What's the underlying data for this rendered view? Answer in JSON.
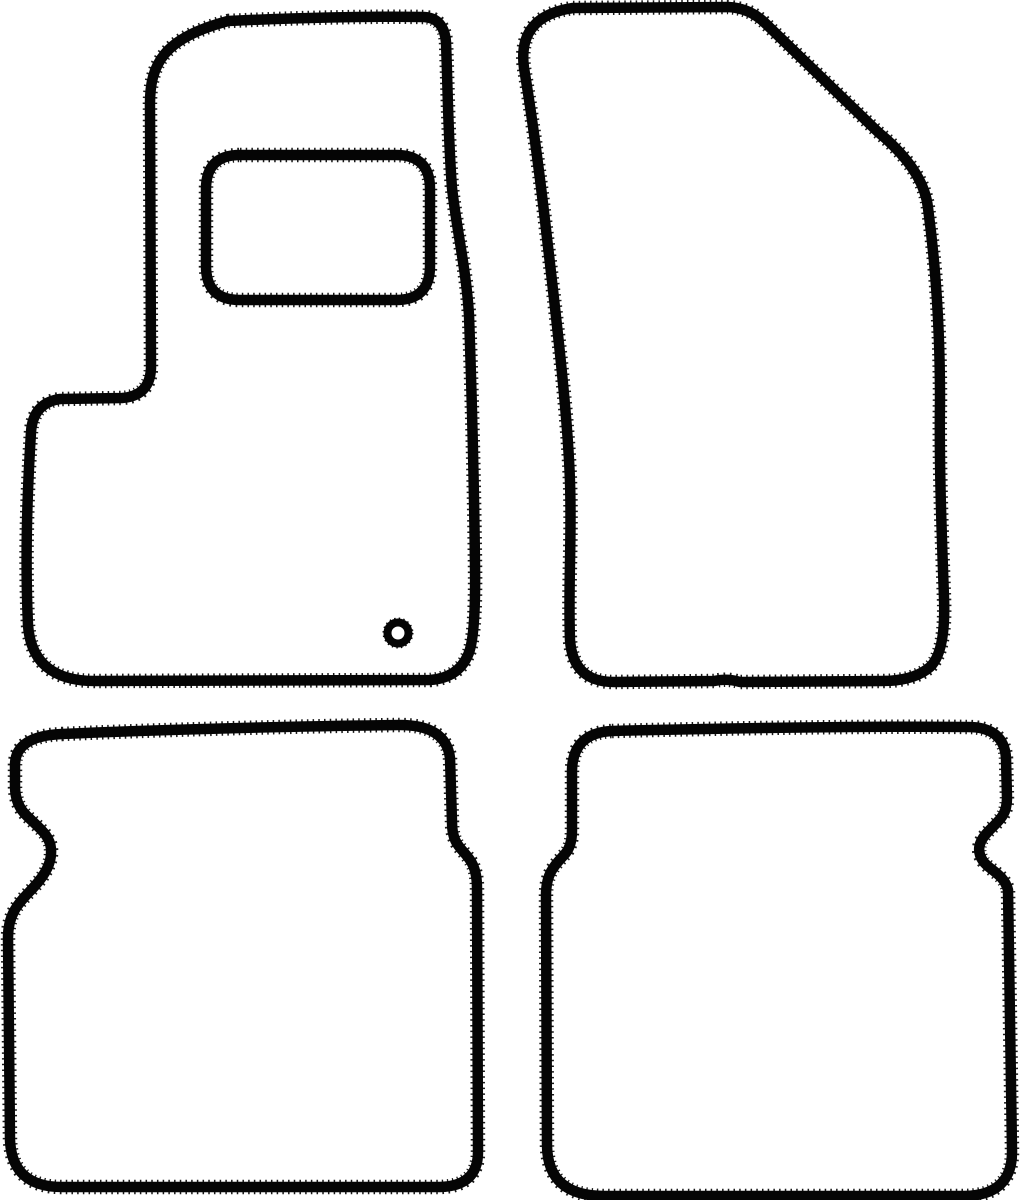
{
  "meta": {
    "description": "Outline template drawing of a four-piece car floor mat set",
    "pieces_count": "4"
  },
  "colors": {
    "background": "#ffffff",
    "line": "#050505"
  },
  "stroke": {
    "width_main": "10.5",
    "width_serration": "14.5",
    "serration_dash": "1.5 4.2",
    "grommet_teeth_dash": "1.3 2.8"
  },
  "mats": {
    "front_left": {
      "name": "driver-front-mat",
      "path": "M 228 21 C 290 18 370 16 424 17 Q 444 18 446 42 C 448 95 448 135 452 188 C 457 232 466 268 469 315 C 472 400 474 480 475 565 Q 476 638 468 655 Q 458 678 430 680 L 95 681 Q 32 681 28 625 C 25 560 27 495 31 432 Q 33 403 60 399 L 122 398 Q 150 396 151 368 L 150 108 C 149 62 165 38 228 21 Z"
    },
    "front_left_heel_pad": {
      "name": "driver-heel-pad",
      "path": "M 240 155 L 396 155 Q 430 155 430 189 L 430 266 Q 430 300 396 300 L 240 300 Q 206 300 206 266 L 206 189 Q 206 155 240 155 Z"
    },
    "front_left_grommet": {
      "name": "driver-mat-fixing-grommet",
      "cx": "398",
      "cy": "633",
      "r_body": "10.5",
      "r_teeth": "13",
      "body_stroke_width": "8",
      "teeth_stroke_width": "5"
    },
    "front_right": {
      "name": "passenger-front-mat",
      "path": "M 573 8 L 728 7 Q 749 8 764 22 L 878 132 Q 924 170 928 208 C 935 260 940 320 940 400 C 939 470 942 540 944 598 Q 946 652 930 667 Q 914 681 882 681 L 740 682 Q 727 678 714 681 L 614 682 Q 573 682 570 640 C 568 585 572 540 570 482 C 568 420 558 332 547 238 C 541 185 533 122 524 68 Q 517 16 573 8 Z"
    },
    "rear_left": {
      "name": "rear-left-mat",
      "path": "M 62 734 C 150 730 300 726 400 725 Q 446 725 450 758 L 452 822 C 452 845 462 848 470 860 Q 477 870 477 888 L 478 1152 Q 478 1186 440 1187 L 62 1187 Q 12 1187 10 1140 L 8 938 C 8 912 20 902 33 888 C 46 874 52 862 51 849 C 50 835 38 827 27 816 Q 15 805 15 786 L 15 765 Q 15 736 62 734 Z"
    },
    "rear_right": {
      "name": "rear-right-mat",
      "path": "M 612 731 C 730 728 880 726 968 727 Q 1004 727 1006 758 L 1007 798 C 1007 818 996 822 986 834 C 978 843 977 852 983 861 C 989 870 1004 874 1008 890 L 1012 1150 Q 1013 1195 965 1196 L 604 1196 Q 548 1196 547 1146 L 546 895 C 546 872 556 864 565 854 Q 572 846 572 830 L 572 770 Q 573 733 612 731 Z"
    }
  }
}
